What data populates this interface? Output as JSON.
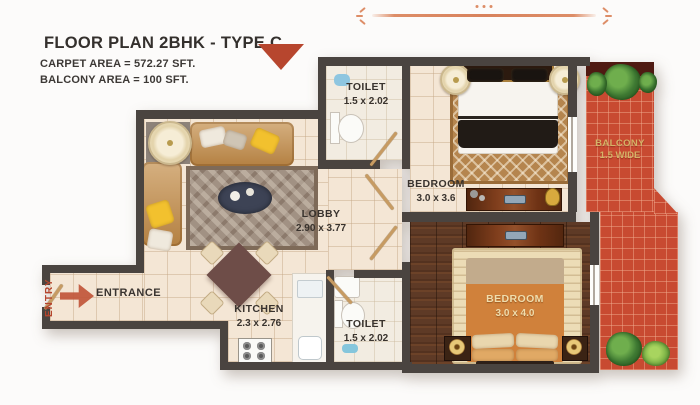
{
  "header": {
    "title": "FLOOR PLAN 2BHK - TYPE C",
    "carpet_area": "CARPET AREA = 572.27 SFT.",
    "balcony_area": "BALCONY AREA = 100 SFT."
  },
  "rooms": {
    "toilet_top": {
      "label": "TOILET",
      "dims": "1.5 x 2.02"
    },
    "bedroom_top": {
      "label": "BEDROOM",
      "dims": "3.0 x 3.6"
    },
    "balcony": {
      "label": "BALCONY",
      "dims": "1.5 WIDE"
    },
    "lobby": {
      "label": "LOBBY",
      "dims": "2.90 x 3.77"
    },
    "kitchen": {
      "label": "KITCHEN",
      "dims": "2.3 x 2.76"
    },
    "toilet_bottom": {
      "label": "TOILET",
      "dims": "1.5 x 2.02"
    },
    "bedroom_bottom": {
      "label": "BEDROOM",
      "dims": "3.0 x 4.0"
    },
    "entrance": {
      "label": "ENTRANCE"
    },
    "entry": {
      "label": "ENTRY"
    }
  },
  "colors": {
    "wall": "#4a4440",
    "floor_cream": "#f4e6d5",
    "wood_floor": "#5e3a26",
    "balcony_brick": "#c84a31",
    "accent_red_triangle": "#b7462e",
    "entry_red": "#b5452e",
    "ornament_orange": "#dd8d67",
    "sofa_tan": "#c5914f",
    "pillow_yellow": "#f2c12e",
    "balcony_label_gold": "#d5b266",
    "bedroom_label_cream": "#f0ddad"
  }
}
